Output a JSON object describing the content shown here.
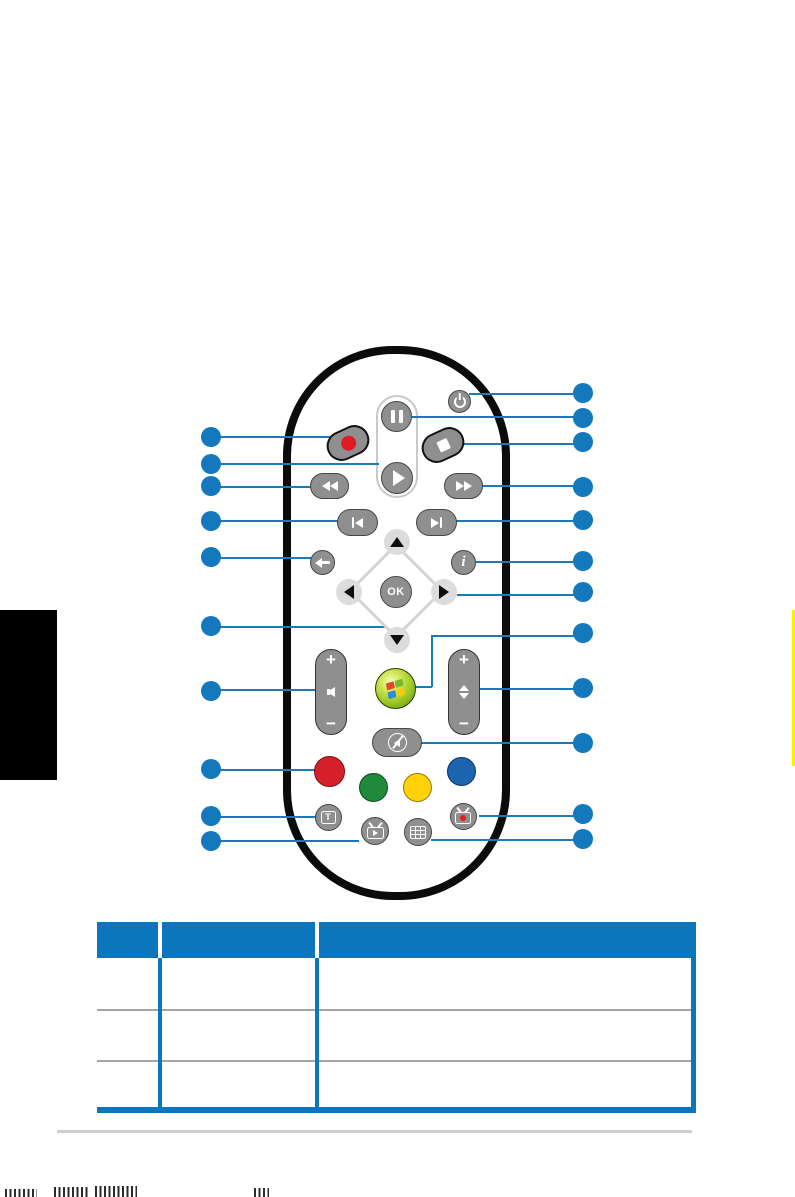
{
  "remote": {
    "ok_label": "OK",
    "info_label": "i",
    "teletext_label": "T",
    "volume": {
      "plus": "+",
      "minus": "−"
    },
    "channel": {
      "plus": "+",
      "minus": "−"
    },
    "icon_names": [
      "power-icon",
      "pause-icon",
      "record-icon",
      "stop-icon",
      "play-icon",
      "rewind-icon",
      "fast-forward-icon",
      "previous-track-icon",
      "next-track-icon",
      "back-arrow-icon",
      "info-icon",
      "dpad-up-icon",
      "dpad-down-icon",
      "dpad-left-icon",
      "dpad-right-icon",
      "ok-button",
      "volume-rocker",
      "windows-media-center-icon",
      "channel-rocker",
      "mute-icon",
      "red-button",
      "green-button",
      "yellow-button",
      "blue-button",
      "teletext-icon",
      "tv-play-icon",
      "guide-icon",
      "recorded-tv-icon"
    ]
  },
  "callouts": {
    "left_count": 10,
    "right_count": 12
  },
  "table": {
    "columns": 3,
    "header_rows": 1,
    "body_rows": 3,
    "visible_text": ""
  },
  "colors": {
    "callout_blue": "#1478BD",
    "connector_blue": "#1D7AB8",
    "table_blue": "#0B76BC",
    "row_divider_gray": "#A5A5A5",
    "button_gray": "#8F8F8F",
    "record_red": "#E01B24",
    "color_button_red": "#D6212B",
    "color_button_green": "#1F8A3B",
    "color_button_yellow": "#FFD20A",
    "color_button_blue": "#1D64AE",
    "edge_tab_black": "#000000",
    "edge_strip_yellow": "#FFEF00"
  }
}
